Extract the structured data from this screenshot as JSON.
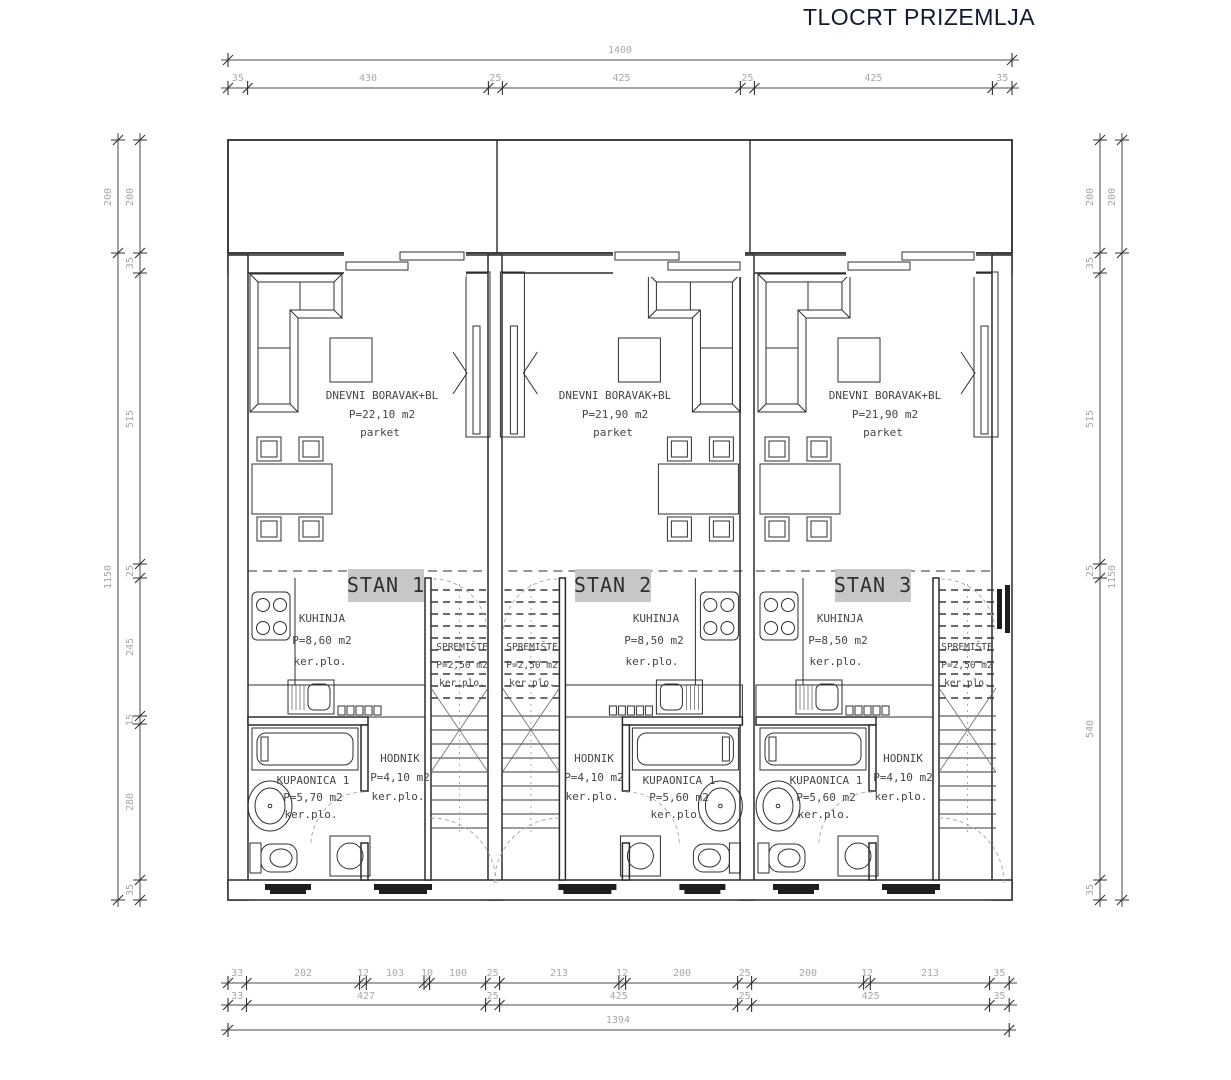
{
  "title": "TLOCRT PRIZEMLJA",
  "colors": {
    "line": "#2b2b2b",
    "dim_text": "#a8a8a8",
    "stan_highlight": "#c7c7c7",
    "background": "#ffffff"
  },
  "dims": {
    "top_total": "1400",
    "top_segments": [
      "35",
      "430",
      "25",
      "425",
      "25",
      "425",
      "35"
    ],
    "left_outer": [
      "200",
      "1150"
    ],
    "left_inner": [
      "200",
      "35",
      "515",
      "25",
      "245",
      "15",
      "280",
      "35"
    ],
    "right_inner": [
      "200",
      "35",
      "515",
      "25",
      "540",
      "35"
    ],
    "right_outer": [
      "200",
      "1150"
    ],
    "bottom_row1": [
      "33",
      "202",
      "12",
      "103",
      "10",
      "100",
      "25",
      "213",
      "12",
      "200",
      "25",
      "200",
      "12",
      "213",
      "35"
    ],
    "bottom_row2": [
      "33",
      "427",
      "25",
      "425",
      "25",
      "425",
      "35"
    ],
    "bottom_total": "1394"
  },
  "apartments": [
    {
      "label": "STAN 1",
      "living": {
        "name": "DNEVNI BORAVAK+BL",
        "area": "P=22,10 m2",
        "floor": "parket"
      },
      "kitchen": {
        "name": "KUHINJA",
        "area": "P=8,60 m2",
        "floor": "ker.plo."
      },
      "storage": {
        "name": "SPREMIŠTE",
        "area": "P=2,50 m2",
        "floor": "ker.plo."
      },
      "hall": {
        "name": "HODNIK",
        "area": "P=4,10 m2",
        "floor": "ker.plo."
      },
      "bath": {
        "name": "KUPAONICA 1",
        "area": "P=5,70 m2",
        "floor": "ker.plo."
      }
    },
    {
      "label": "STAN 2",
      "living": {
        "name": "DNEVNI BORAVAK+BL",
        "area": "P=21,90 m2",
        "floor": "parket"
      },
      "kitchen": {
        "name": "KUHINJA",
        "area": "P=8,50 m2",
        "floor": "ker.plo."
      },
      "storage": {
        "name": "SPREMIŠTE",
        "area": "P=2,50 m2",
        "floor": "ker.plo."
      },
      "hall": {
        "name": "HODNIK",
        "area": "P=4,10 m2",
        "floor": "ker.plo."
      },
      "bath": {
        "name": "KUPAONICA 1",
        "area": "P=5,60 m2",
        "floor": "ker.plo."
      }
    },
    {
      "label": "STAN 3",
      "living": {
        "name": "DNEVNI BORAVAK+BL",
        "area": "P=21,90 m2",
        "floor": "parket"
      },
      "kitchen": {
        "name": "KUHINJA",
        "area": "P=8,50 m2",
        "floor": "ker.plo."
      },
      "storage": {
        "name": "SPREMIŠTE",
        "area": "P=2,50 m2",
        "floor": "ker.plo."
      },
      "hall": {
        "name": "HODNIK",
        "area": "P=4,10 m2",
        "floor": "ker.plo."
      },
      "bath": {
        "name": "KUPAONICA 1",
        "area": "P=5,60 m2",
        "floor": "ker.plo."
      }
    }
  ]
}
